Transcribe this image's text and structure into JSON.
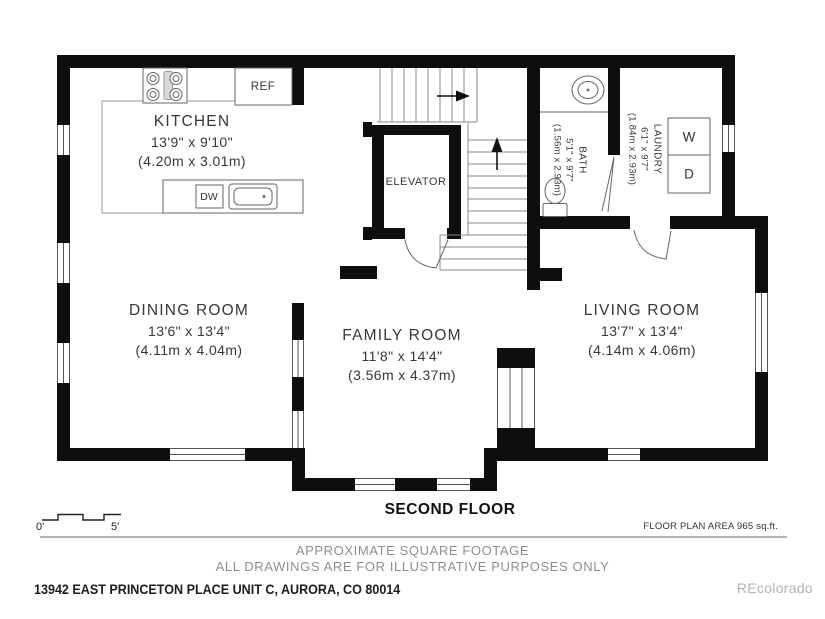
{
  "title": "SECOND FLOOR",
  "area_label": "FLOOR PLAN AREA 965 sq.ft.",
  "scale_bar": {
    "start": "0'",
    "end": "5'"
  },
  "rooms": {
    "kitchen": {
      "name": "KITCHEN",
      "size_ft": "13'9\" x 9'10\"",
      "size_m": "(4.20m x 3.01m)"
    },
    "dining": {
      "name": "DINING ROOM",
      "size_ft": "13'6\" x 13'4\"",
      "size_m": "(4.11m x 4.04m)"
    },
    "family": {
      "name": "FAMILY ROOM",
      "size_ft": "11'8\" x 14'4\"",
      "size_m": "(3.56m x 4.37m)"
    },
    "living": {
      "name": "LIVING ROOM",
      "size_ft": "13'7\" x 13'4\"",
      "size_m": "(4.14m x 4.06m)"
    },
    "bath": {
      "name": "BATH",
      "size_ft": "5'1\" x 9'7\"",
      "size_m": "(1.56m x 2.93m)"
    },
    "laundry": {
      "name": "LAUNDRY",
      "size_ft": "6'1\" x 9'7\"",
      "size_m": "(1.84m x 2.93m)"
    },
    "elevator": {
      "name": "ELEVATOR"
    }
  },
  "fixtures": {
    "refrigerator": "REF",
    "dishwasher": "DW",
    "washer": "W",
    "dryer": "D"
  },
  "disclaimer": [
    "APPROXIMATE SQUARE FOOTAGE",
    "ALL DRAWINGS ARE FOR ILLUSTRATIVE PURPOSES ONLY"
  ],
  "address": "13942 EAST PRINCETON PLACE UNIT C, AURORA, CO 80014",
  "watermark": "REcolorado",
  "colors": {
    "wall": "#0e0e0e",
    "thin_line": "#777777",
    "text": "#383838",
    "muted_text": "#8e8e8e",
    "watermark": "#b2b2b2"
  }
}
